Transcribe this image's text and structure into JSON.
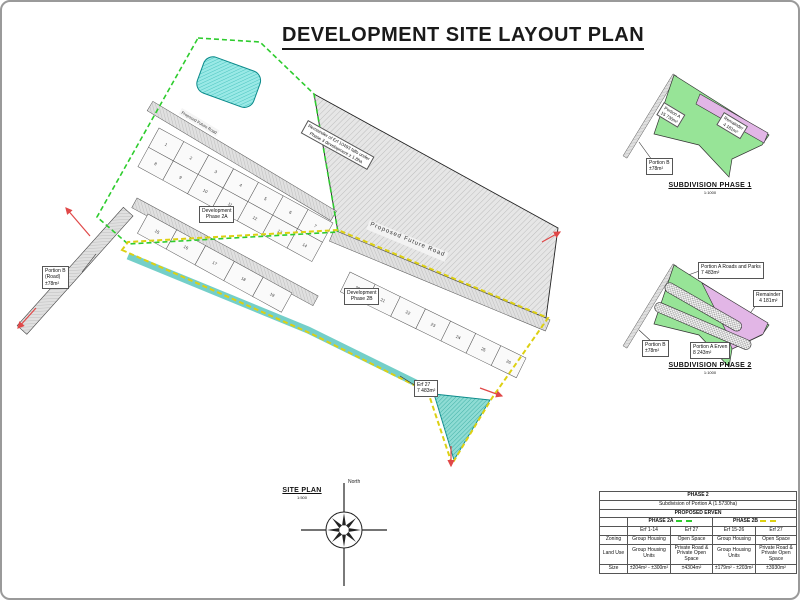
{
  "title": "DEVELOPMENT SITE LAYOUT PLAN",
  "colors": {
    "phase2a_boundary": "#2ecc2e",
    "phase2b_boundary": "#ddd012",
    "green_area": "#97e497",
    "pink_area": "#e2b6e6",
    "pond": "#9ae9e6",
    "arrow": "#e04848"
  },
  "plan": {
    "road_label_1": "Proposed Future Road",
    "road_label_2": "Proposed Future Road",
    "phase2a_label": {
      "line1": "Development",
      "line2": "Phase 2A"
    },
    "phase2b_label": {
      "line1": "Development",
      "line2": "Phase 2B"
    },
    "portion_b_label": {
      "line1": "Portion B",
      "line2": "(Road)",
      "line3": "±78m²"
    },
    "erf27_label": {
      "line1": "Erf 27",
      "line2": "7 483m²"
    },
    "remainder_note": {
      "line1": "Remainder of Erf 10493 falls under",
      "line2": "Phase 3 development ± 1.8ha"
    },
    "erven_band1_row1": [
      "1",
      "2",
      "3",
      "4",
      "5",
      "6",
      "7"
    ],
    "erven_band1_row2": [
      "8",
      "9",
      "10",
      "11",
      "12",
      "13",
      "14"
    ],
    "erven_band2": [
      "15",
      "16",
      "17",
      "18",
      "19"
    ],
    "erven_band3": [
      "20",
      "21",
      "22",
      "23",
      "24",
      "25",
      "26"
    ]
  },
  "compass": {
    "north_label": "North"
  },
  "site_plan_caption": {
    "title": "SITE PLAN",
    "scale": "1:500"
  },
  "phase1_inset": {
    "portion_a": {
      "line1": "Portion A",
      "line2": "15 730m²"
    },
    "remainder": {
      "line1": "Remainder",
      "line2": "4 181m²"
    },
    "portion_b": {
      "line1": "Portion B",
      "line2": "±78m²"
    },
    "caption": "SUBDIVISION PHASE 1",
    "scale": "1:1000"
  },
  "phase2_inset": {
    "roads_parks": {
      "line1": "Portion A Roads and Parks",
      "line2": "7 483m²"
    },
    "remainder": {
      "line1": "Remainder",
      "line2": "4 181m²"
    },
    "portion_b": {
      "line1": "Portion B",
      "line2": "±78m²"
    },
    "erven": {
      "line1": "Portion A Erven",
      "line2": "8 243m²"
    },
    "caption": "SUBDIVISION PHASE 2",
    "scale": "1:1000"
  },
  "table": {
    "phase_title": "PHASE 2",
    "subtitle": "Subdivision of Portion A (1.5730ha)",
    "header": "PROPOSED ERVEN",
    "col_groups": [
      {
        "label": "PHASE 2A"
      },
      {
        "label": "PHASE 2B"
      }
    ],
    "erf_cols": [
      "Erf 1-14",
      "Erf 27",
      "Erf 15-26",
      "Erf 27"
    ],
    "rows": [
      {
        "label": "Zoning",
        "cells": [
          "Group Housing",
          "Open Space",
          "Group Housing",
          "Open Space"
        ]
      },
      {
        "label": "Land Use",
        "cells": [
          "Group Housing Units",
          "Private Road & Private Open Space",
          "Group Housing Units",
          "Private Road & Private Open Space"
        ]
      },
      {
        "label": "Size",
        "cells": [
          "±204m² - ±300m²",
          "±4304m²",
          "±179m² - ±203m²",
          "±3930m²"
        ]
      }
    ]
  }
}
